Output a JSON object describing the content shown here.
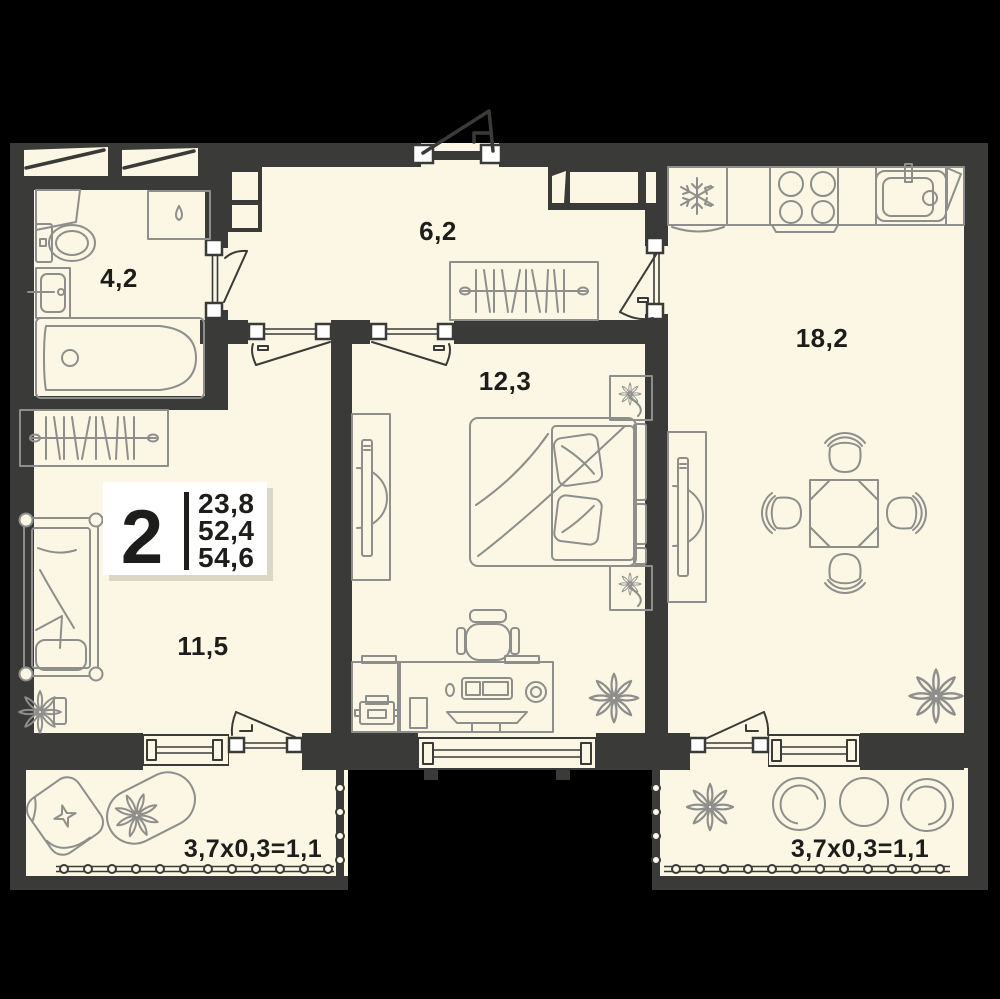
{
  "legend": {
    "room_count": "2",
    "values": [
      "23,8",
      "52,4",
      "54,6"
    ]
  },
  "rooms": {
    "bathroom": {
      "area_label": "4,2"
    },
    "hallway": {
      "area_label": "6,2"
    },
    "bedroom": {
      "area_label": "12,3"
    },
    "kitchen_living": {
      "area_label": "18,2"
    },
    "second_room": {
      "area_label": "11,5"
    }
  },
  "balconies": {
    "left": {
      "area_label": "3,7x0,3=1,1"
    },
    "right": {
      "area_label": "3,7x0,3=1,1"
    }
  },
  "icons": [
    "snowflake-icon",
    "droplet-icon",
    "flower-icon",
    "hangers-icon"
  ],
  "colors": {
    "background": "#000000",
    "wall": "#3a3a38",
    "floor": "#fbf7e4",
    "furniture_line": "#8e8e8c",
    "label_ink": "#1d1d1b",
    "card": "#ffffff"
  }
}
